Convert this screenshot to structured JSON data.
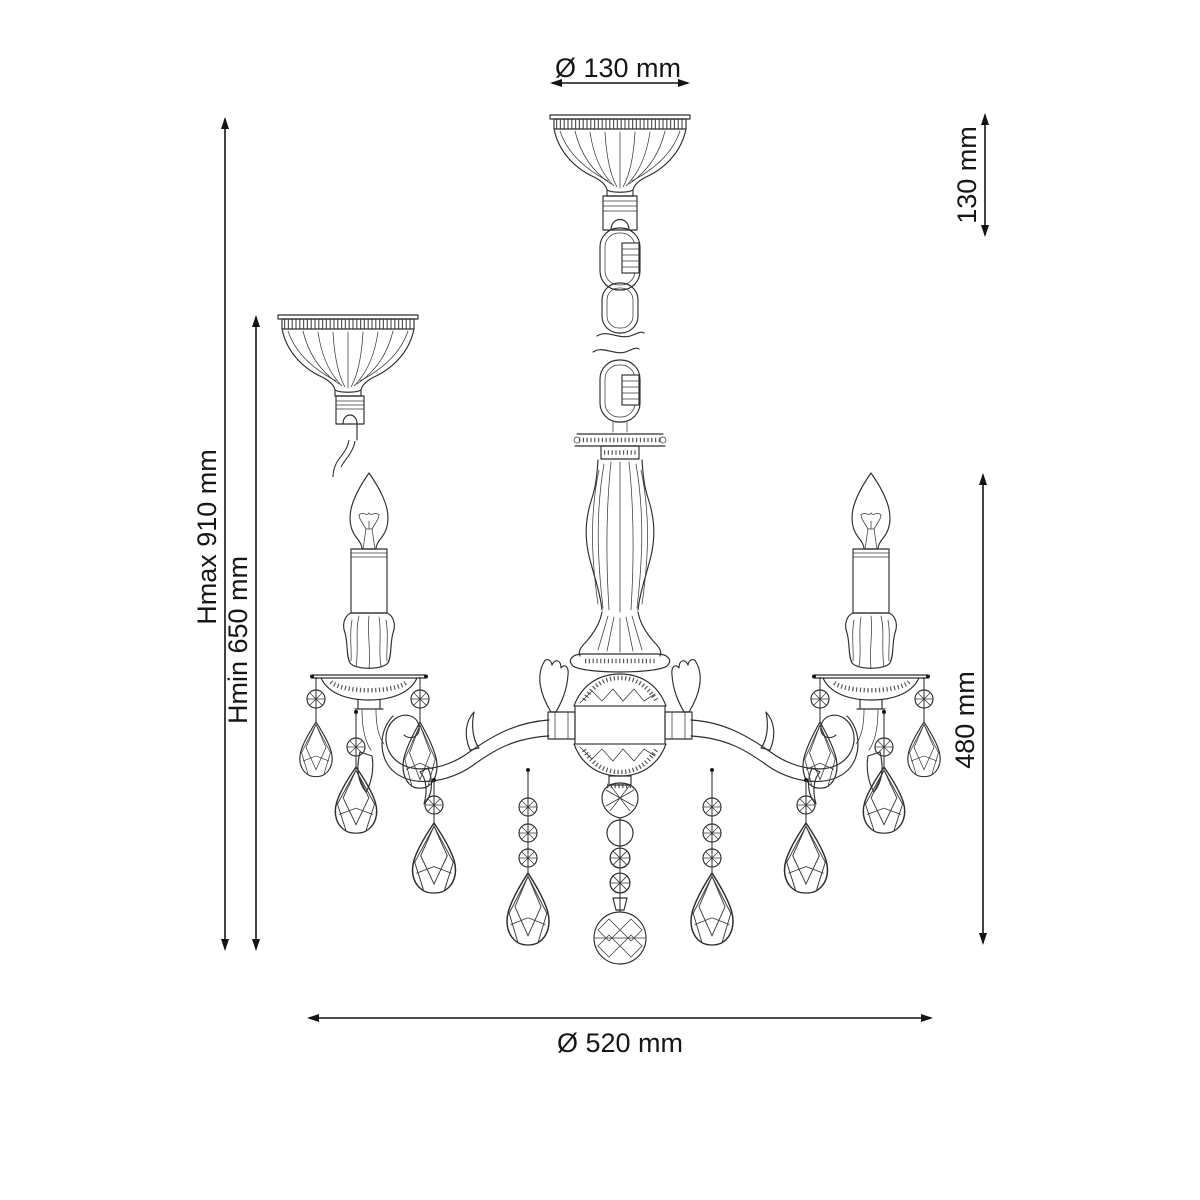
{
  "meta": {
    "title": "Chandelier technical dimension drawing"
  },
  "dims": {
    "canopy_diameter": "Ø 130 mm",
    "canopy_height": "130 mm",
    "height_max": "Hmax 910 mm",
    "height_min": "Hmin 650 mm",
    "body_height": "480 mm",
    "fixture_diameter": "Ø 520 mm"
  },
  "colors": {
    "line": "#2e2e2e",
    "dimension": "#141414",
    "background": "#ffffff"
  }
}
